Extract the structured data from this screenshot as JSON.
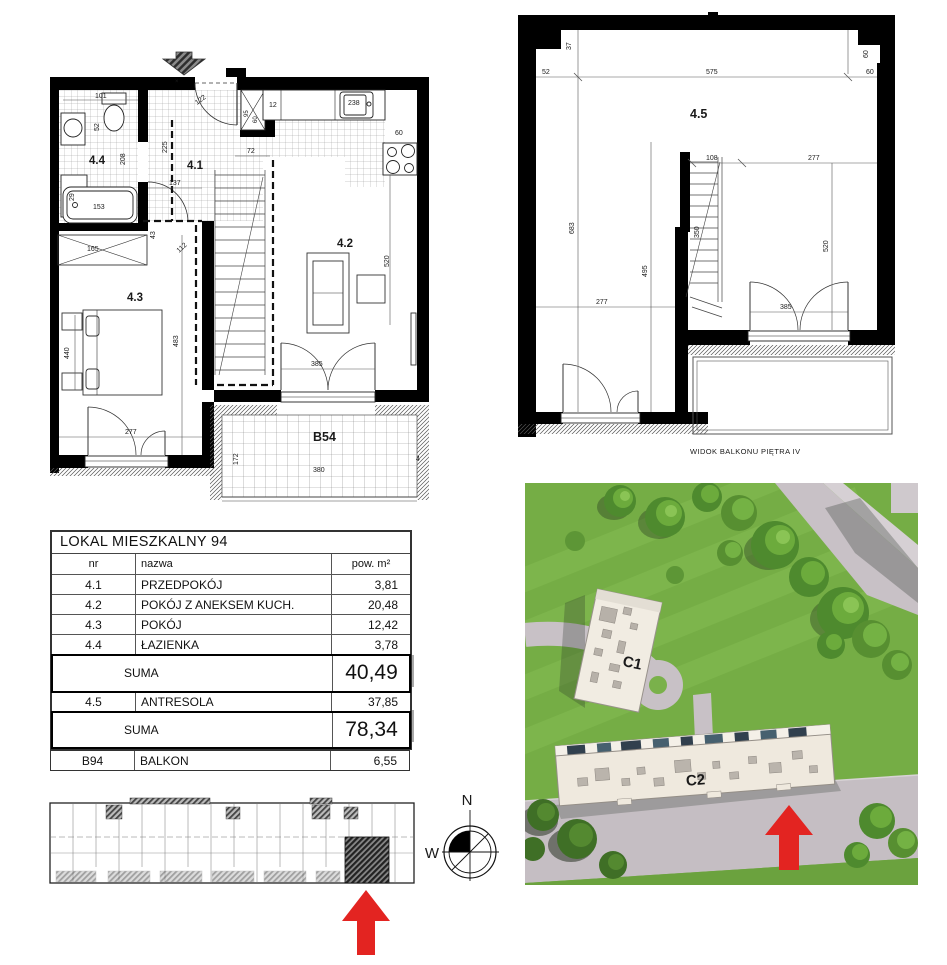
{
  "plan_left": {
    "rooms": {
      "r44": "4.4",
      "r41": "4.1",
      "r42": "4.2",
      "r43": "4.3"
    },
    "balcony_label": "B54",
    "entrance_mark": "×",
    "dims": {
      "d101": "101",
      "d52": "52",
      "d29": "29",
      "d153": "153",
      "d208": "208",
      "d165": "165",
      "d112": "112",
      "d122": "122",
      "d95": "95",
      "d60_shaft": "60",
      "d72": "72",
      "d225": "225",
      "d137": "137",
      "d43": "43",
      "d12": "12",
      "d238": "238",
      "d60_k": "60",
      "d520": "520",
      "d440": "440",
      "d483": "483",
      "d277": "277",
      "d385": "385",
      "d172": "172",
      "d380": "380",
      "d4": "4"
    }
  },
  "plan_right": {
    "room": "4.5",
    "caption": "WIDOK BALKONU PIĘTRA IV",
    "dims": {
      "d37": "37",
      "d52": "52",
      "d575": "575",
      "d60v": "60",
      "d60h": "60",
      "d683": "683",
      "d495": "495",
      "d277l": "277",
      "d108": "108",
      "d350": "350",
      "d277r": "277",
      "d520": "520",
      "d385": "385"
    }
  },
  "table": {
    "title": "LOKAL MIESZKALNY 94",
    "headers": {
      "nr": "nr",
      "nazwa": "nazwa",
      "pow": "pow. m²"
    },
    "rows": [
      {
        "nr": "4.1",
        "nazwa": "PRZEDPOKÓJ",
        "pow": "3,81"
      },
      {
        "nr": "4.2",
        "nazwa": "POKÓJ Z ANEKSEM KUCH.",
        "pow": "20,48"
      },
      {
        "nr": "4.3",
        "nazwa": "POKÓJ",
        "pow": "12,42"
      },
      {
        "nr": "4.4",
        "nazwa": "ŁAZIENKA",
        "pow": "3,78"
      }
    ],
    "suma1": {
      "label": "SUMA",
      "value": "40,49"
    },
    "row45": {
      "nr": "4.5",
      "nazwa": "ANTRESOLA",
      "pow": "37,85"
    },
    "suma2": {
      "label": "SUMA",
      "value": "78,34"
    },
    "balkon": {
      "nr": "B94",
      "nazwa": "BALKON",
      "pow": "6,55"
    }
  },
  "compass": {
    "n": "N",
    "w": "W"
  },
  "render": {
    "c1": "C1",
    "c2": "C2"
  },
  "colors": {
    "arrow_red": "#e32421",
    "label_green": "#79b440",
    "grass": "#75ad45",
    "road": "#c8c1c6"
  }
}
